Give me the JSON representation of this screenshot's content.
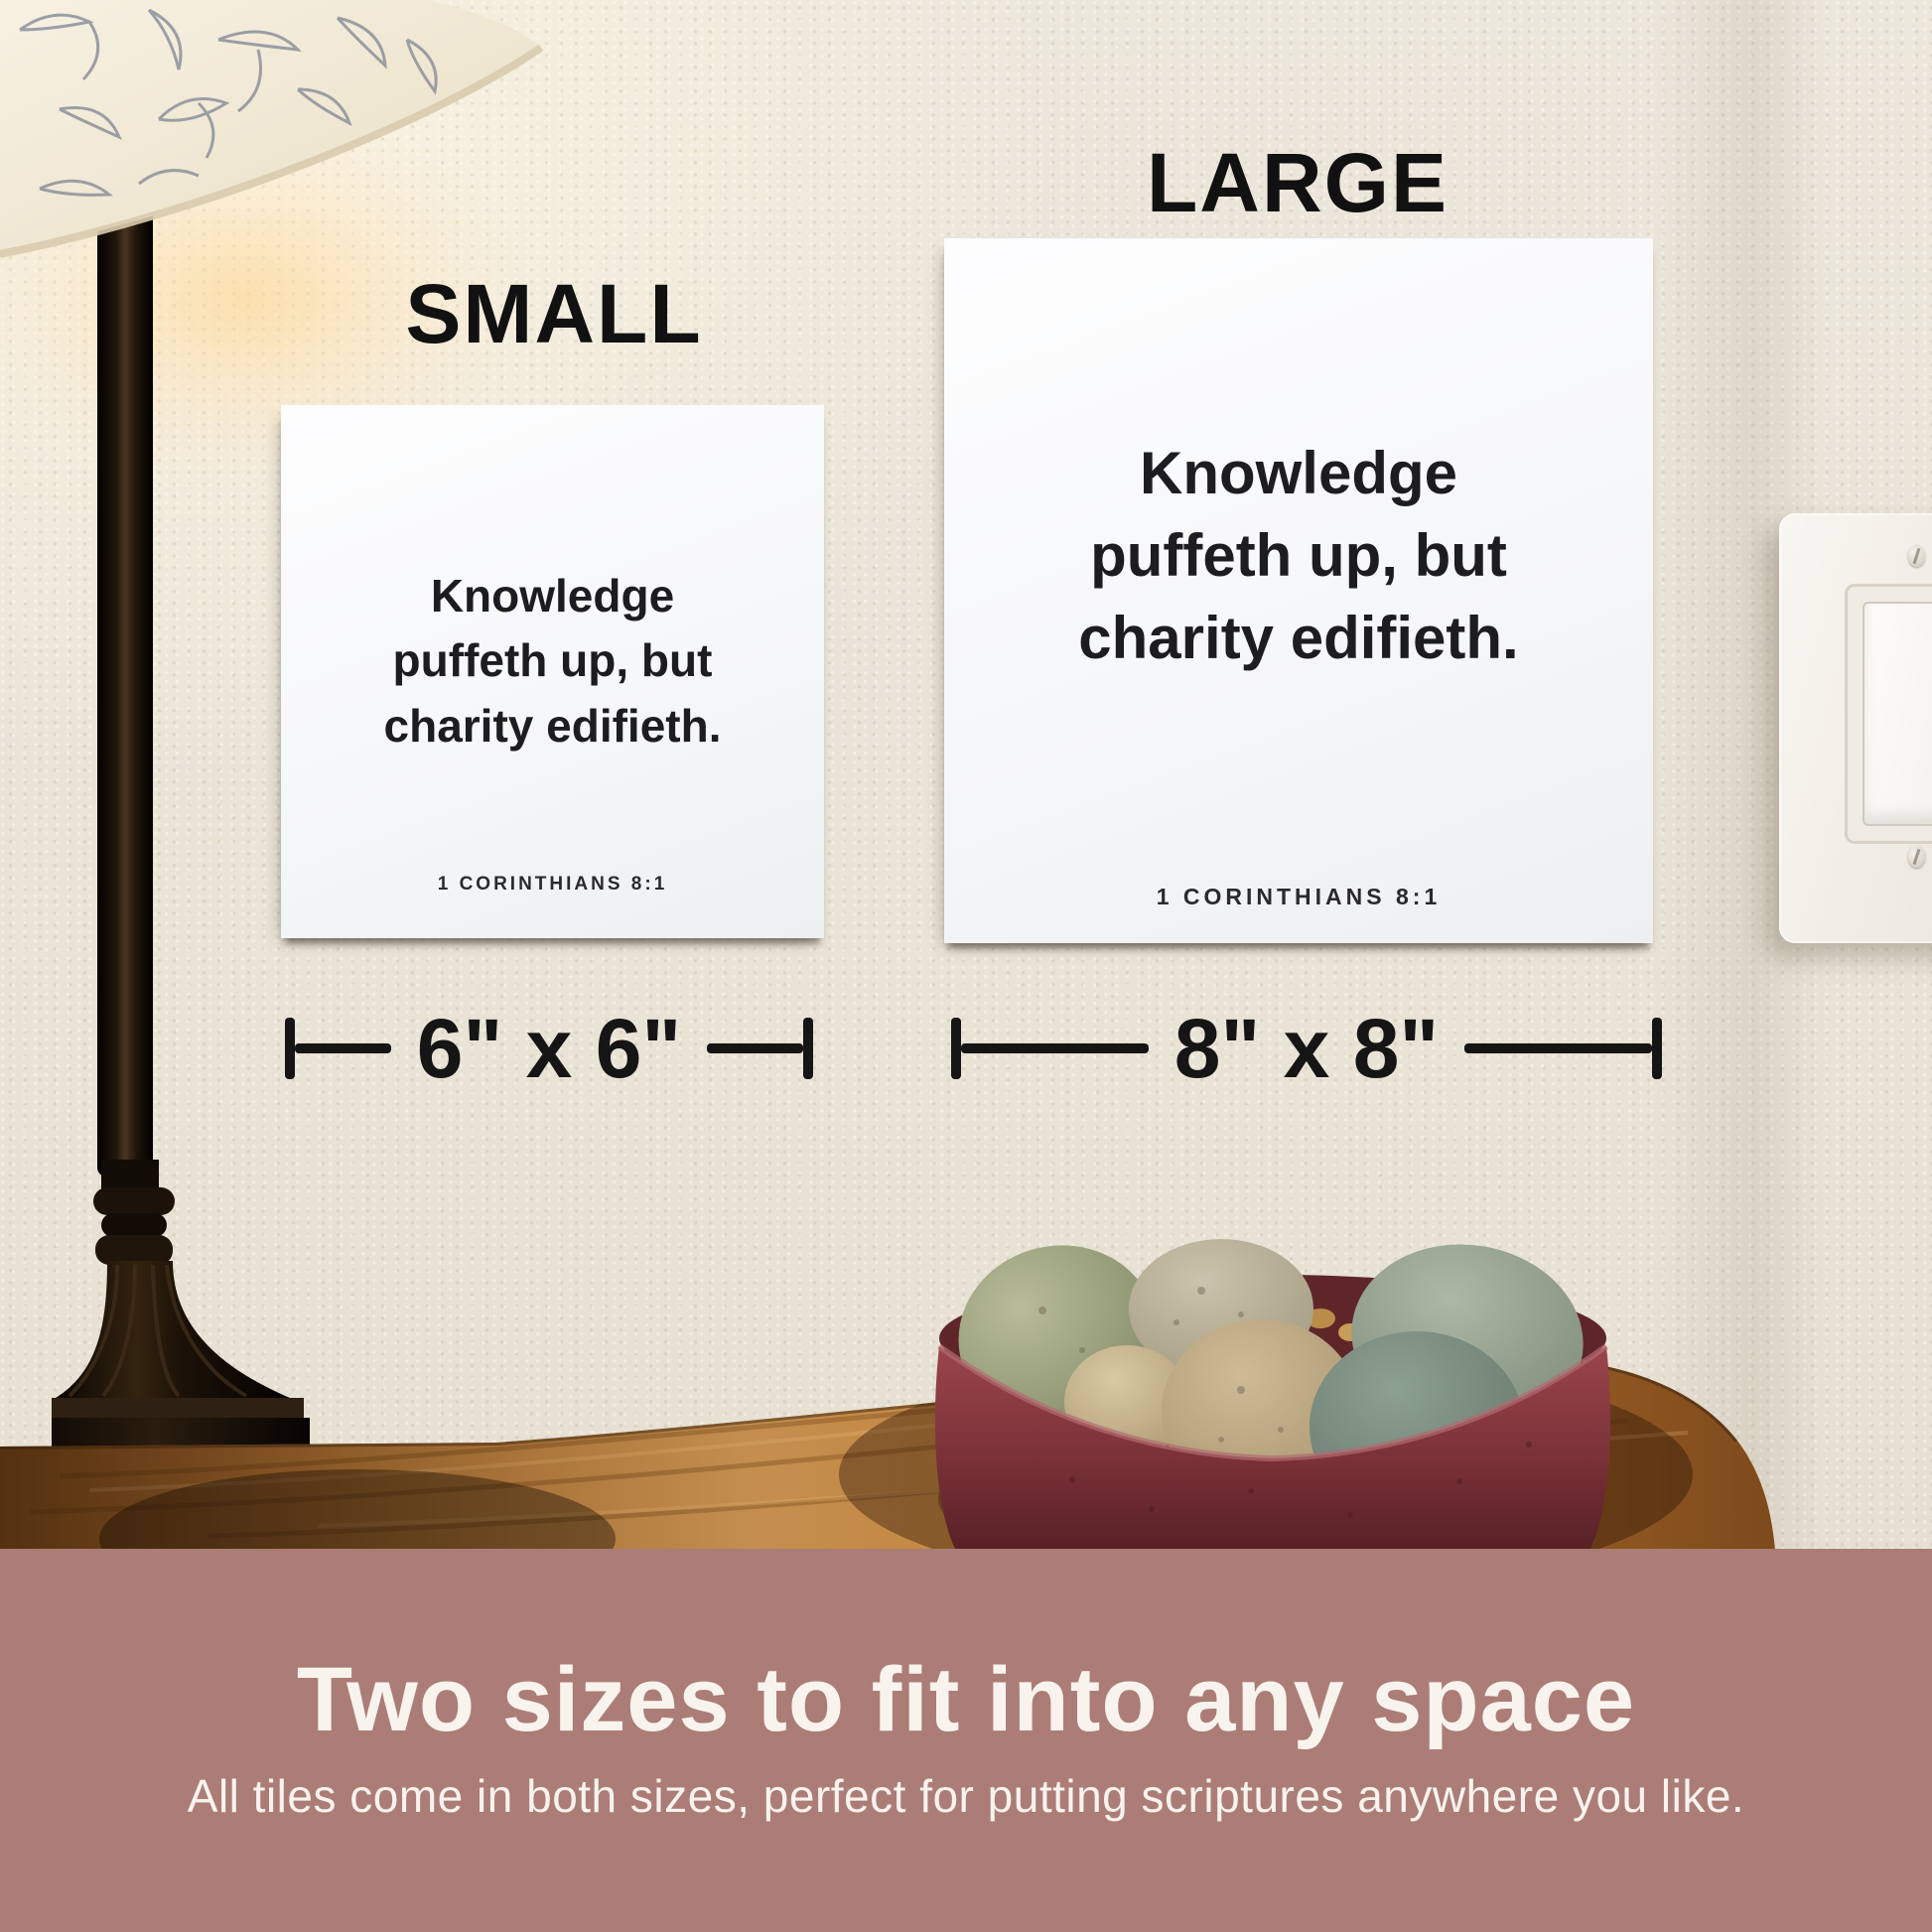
{
  "photo": {
    "labels": {
      "small": "SMALL",
      "large": "LARGE"
    },
    "tile": {
      "line1": "Knowledge",
      "line2": "puffeth up, but",
      "line3": "charity edifieth.",
      "reference": "1 CORINTHIANS 8:1"
    },
    "dimensions": {
      "small": "6\" x 6\"",
      "large": "8\" x 8\""
    },
    "caption": {
      "heading": "Two sizes to fit into any space",
      "subheading": "All tiles come in both sizes, perfect for putting scriptures anywhere you like."
    },
    "colors": {
      "band": "#ab7d76",
      "wall": "#e9e4d8",
      "tile": "#f8f8fa",
      "tile_text": "#1d1d1f",
      "caption_text": "#f9f3ee",
      "wood": "#b5742c",
      "bowl": "#82343a",
      "lamp": "#17100a",
      "annotation": "#151515"
    }
  }
}
